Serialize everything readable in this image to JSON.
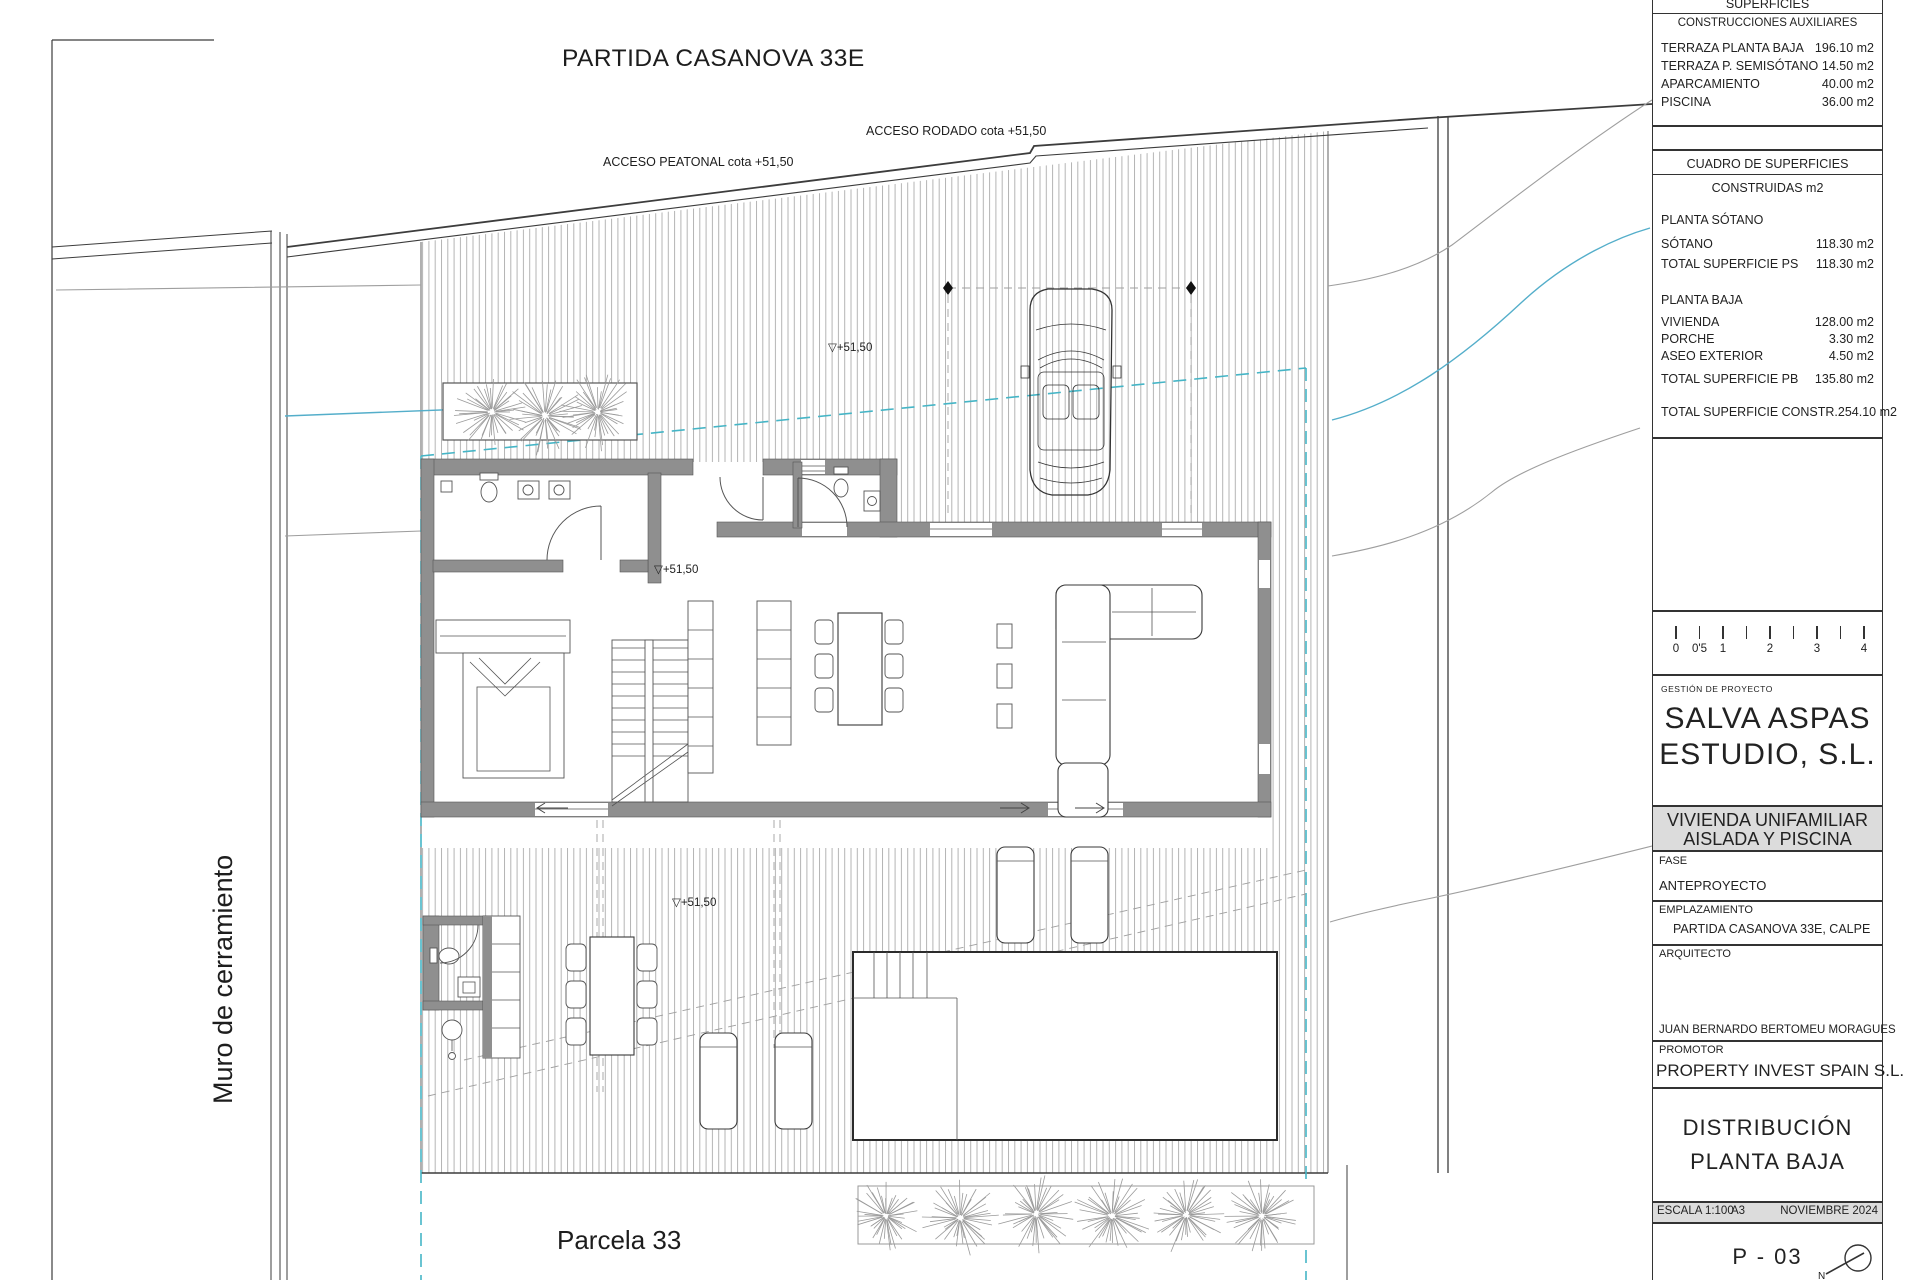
{
  "plan": {
    "title": "PARTIDA CASANOVA 33E",
    "labels": {
      "acceso_rodado": "ACCESO RODADO cota +51,50",
      "acceso_peatonal": "ACCESO PEATONAL cota +51,50",
      "muro": "Muro de cerramiento",
      "parcela": "Parcela 33"
    },
    "cotas": [
      "▽+51,50",
      "▽+51,50",
      "▽+51,50"
    ]
  },
  "titleblock": {
    "superficies_header": "SUPERFICIES",
    "aux": {
      "header": "CONSTRUCCIONES AUXILIARES",
      "rows": [
        {
          "label": "TERRAZA PLANTA BAJA",
          "value": "196.10 m2"
        },
        {
          "label": "TERRAZA P. SEMISÓTANO",
          "value": "14.50 m2"
        },
        {
          "label": "APARCAMIENTO",
          "value": "40.00 m2"
        },
        {
          "label": "PISCINA",
          "value": "36.00 m2"
        }
      ]
    },
    "cuadro": {
      "header": "CUADRO DE SUPERFICIES",
      "subheader": "CONSTRUIDAS m2",
      "section_ps": "PLANTA SÓTANO",
      "rows_ps": [
        {
          "label": "SÓTANO",
          "value": "118.30 m2"
        },
        {
          "label": "TOTAL SUPERFICIE PS",
          "value": "118.30 m2"
        }
      ],
      "section_pb": "PLANTA BAJA",
      "rows_pb": [
        {
          "label": "VIVIENDA",
          "value": "128.00 m2"
        },
        {
          "label": "PORCHE",
          "value": "3.30 m2"
        },
        {
          "label": "ASEO EXTERIOR",
          "value": "4.50 m2"
        },
        {
          "label": "TOTAL SUPERFICIE PB",
          "value": "135.80 m2"
        }
      ],
      "total": {
        "label": "TOTAL SUPERFICIE CONSTR.",
        "value": "254.10 m2"
      }
    },
    "gestion_label": "GESTIÓN DE PROYECTO",
    "studio_line1": "SALVA ASPAS",
    "studio_line2": "ESTUDIO, S.L.",
    "project_line1": "VIVIENDA UNIFAMILIAR",
    "project_line2": "AISLADA Y PISCINA",
    "fase_label": "FASE",
    "fase_value": "ANTEPROYECTO",
    "emplazamiento_label": "EMPLAZAMIENTO",
    "emplazamiento_value": "PARTIDA CASANOVA 33E, CALPE",
    "arquitecto_label": "ARQUITECTO",
    "arquitecto_value": "JUAN BERNARDO BERTOMEU MORAGUES",
    "promotor_label": "PROMOTOR",
    "promotor_value": "PROPERTY INVEST SPAIN S.L.",
    "sheet_title_line1": "DISTRIBUCIÓN",
    "sheet_title_line2": "PLANTA BAJA",
    "escala": "ESCALA 1:100",
    "paper": "A3",
    "date": "NOVIEMBRE 2024",
    "sheet_number": "P - 03",
    "north_label": "N"
  },
  "scalebar": {
    "labels": [
      "0",
      "0'5",
      "1",
      "2",
      "3",
      "4"
    ]
  },
  "colors": {
    "wall": "#8f8f8f",
    "teal": "#45b5c6",
    "blue": "#54aeca",
    "banner": "#dcdcdc",
    "hatch": "#b4b4b4"
  }
}
